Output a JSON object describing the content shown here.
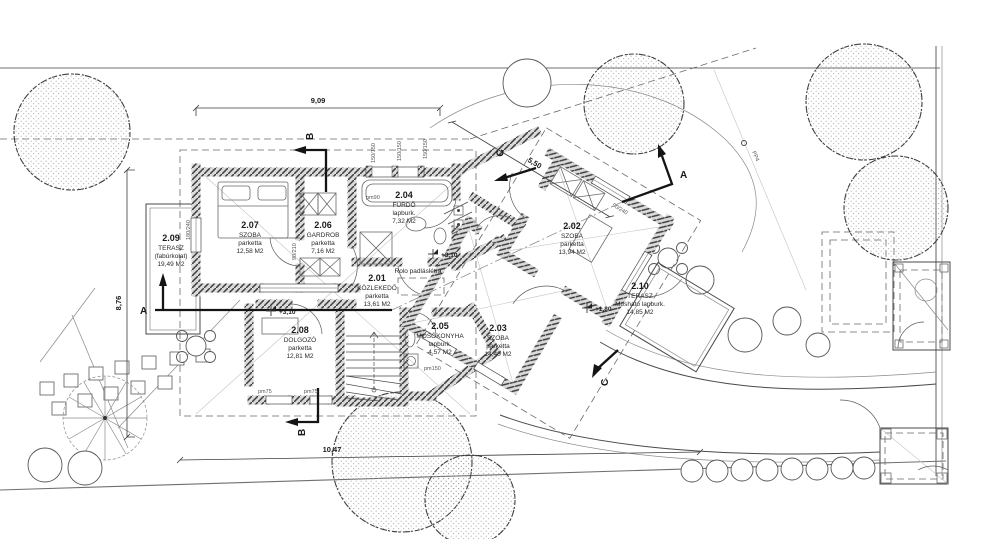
{
  "rooms": [
    {
      "number": "2.01",
      "name": "KÖZLEKEDŐ",
      "finish": "parketta",
      "area": "13,61 M2"
    },
    {
      "number": "2.02",
      "name": "SZOBA",
      "finish": "parketta",
      "area": "13,94 M2"
    },
    {
      "number": "2.03",
      "name": "SZOBA",
      "finish": "parketta",
      "area": "14,40 M2"
    },
    {
      "number": "2.04",
      "name": "FÜRDŐ",
      "finish": "lapburk.",
      "area": "7,32 M2"
    },
    {
      "number": "2.05",
      "name": "MOSÓKONYHA",
      "finish": "lapburk.",
      "area": "4,57 M2"
    },
    {
      "number": "2.06",
      "name": "GARDROB",
      "finish": "parketta",
      "area": "7,16 M2"
    },
    {
      "number": "2.07",
      "name": "SZOBA",
      "finish": "parketta",
      "area": "12,58 M2"
    },
    {
      "number": "2.08",
      "name": "DOLGOZÓ",
      "finish": "parketta",
      "area": "12,81 M2"
    },
    {
      "number": "2.09",
      "name": "TERASZ",
      "finish": "(fabúrkolat)",
      "area": "19,49 M2"
    },
    {
      "number": "2.10",
      "name": "TERASZ",
      "finish": "Mosható lapburk.",
      "area": "14,85 M2"
    }
  ],
  "dims": {
    "top": "9,09",
    "diagonal": "5,50",
    "left": "8,76",
    "bottom": "10,47"
  },
  "sections": {
    "a": "A",
    "b": "B",
    "c": "C"
  },
  "levels": {
    "hall": "+3,10",
    "terrace_sw": "+3,10",
    "terrace_se": "+1,80"
  },
  "notes": {
    "attic_ladder": "Rolo padláslétra",
    "pole": "PP4"
  },
  "small_dims": {
    "d1": "150/150",
    "d2": "150/150",
    "d3": "150/150",
    "d4": "180/240",
    "d5": "90/210",
    "d6": "pm90",
    "d7": "pm150",
    "d8": "pm75",
    "d9": "pm75",
    "d10": "90/240"
  }
}
